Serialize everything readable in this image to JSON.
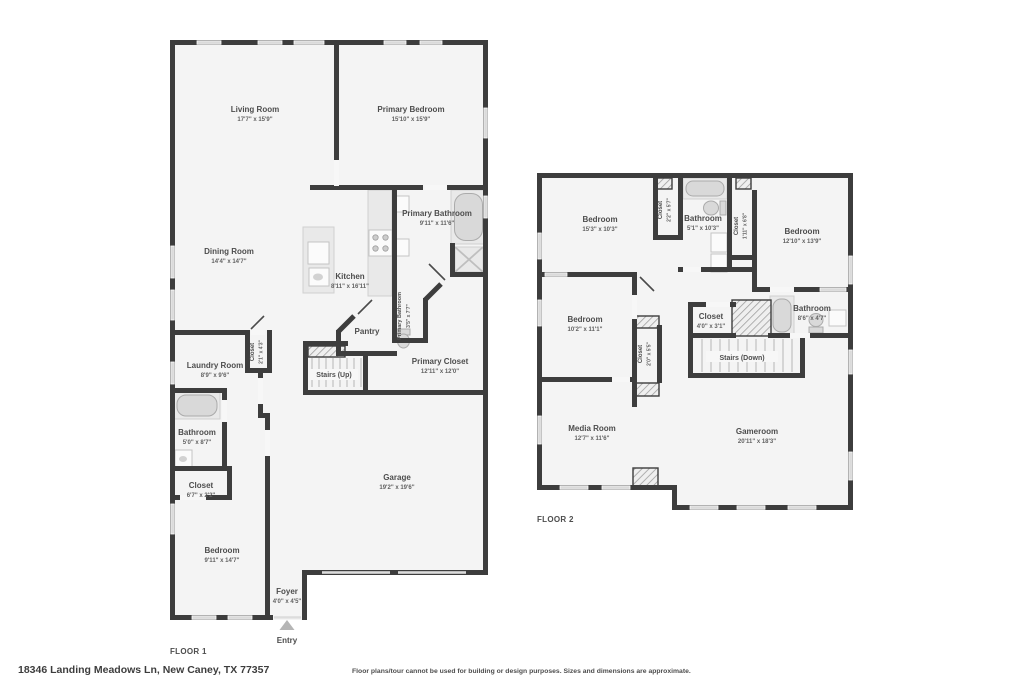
{
  "footer": {
    "address": "18346 Landing Meadows Ln, New Caney, TX 77357",
    "disclaimer": "Floor plans/tour cannot be used for building or design purposes. Sizes and dimensions are approximate."
  },
  "floor1": {
    "title": "FLOOR 1",
    "entry_label": "Entry",
    "rooms": {
      "living_room": {
        "name": "Living Room",
        "dims": "17'7\" x 15'9\""
      },
      "primary_bedroom": {
        "name": "Primary Bedroom",
        "dims": "15'10\" x 15'9\""
      },
      "primary_bathroom": {
        "name": "Primary Bathroom",
        "dims": "9'11\" x 11'6\""
      },
      "dining_room": {
        "name": "Dining Room",
        "dims": "14'4\" x 14'7\""
      },
      "kitchen": {
        "name": "Kitchen",
        "dims": "8'11\" x 16'11\""
      },
      "pantry": {
        "name": "Pantry"
      },
      "water_closet": {
        "name": "Primary Bathroom",
        "dims": "3'5\" x 7'7\""
      },
      "primary_closet": {
        "name": "Primary Closet",
        "dims": "12'11\" x 12'0\""
      },
      "hall_closet": {
        "name": "Closet",
        "dims": "2'1\" x 4'3\""
      },
      "laundry_room": {
        "name": "Laundry Room",
        "dims": "8'9\" x 9'6\""
      },
      "stairs": {
        "name": "Stairs (Up)"
      },
      "bathroom": {
        "name": "Bathroom",
        "dims": "5'0\" x 8'7\""
      },
      "bedroom_closet": {
        "name": "Closet",
        "dims": "6'7\" x 2'2\""
      },
      "bedroom": {
        "name": "Bedroom",
        "dims": "9'11\" x 14'7\""
      },
      "garage": {
        "name": "Garage",
        "dims": "19'2\" x 19'6\""
      },
      "foyer": {
        "name": "Foyer",
        "dims": "4'0\" x 4'5\""
      }
    }
  },
  "floor2": {
    "title": "FLOOR 2",
    "rooms": {
      "bedroom_a": {
        "name": "Bedroom",
        "dims": "15'3\" x 10'3\""
      },
      "closet_a": {
        "name": "Closet",
        "dims": "2'2\" x 5'7\""
      },
      "bathroom_a": {
        "name": "Bathroom",
        "dims": "5'1\" x 10'3\""
      },
      "closet_b": {
        "name": "Closet",
        "dims": "1'11\" x 6'8\""
      },
      "bedroom_b": {
        "name": "Bedroom",
        "dims": "12'10\" x 13'9\""
      },
      "bedroom_c": {
        "name": "Bedroom",
        "dims": "10'2\" x 11'1\""
      },
      "closet_c": {
        "name": "Closet",
        "dims": "2'0\" x 5'5\""
      },
      "closet_d": {
        "name": "Closet",
        "dims": "4'0\" x 3'1\""
      },
      "bathroom_b": {
        "name": "Bathroom",
        "dims": "8'6\" x 4'7\""
      },
      "stairs": {
        "name": "Stairs (Down)"
      },
      "media_room": {
        "name": "Media Room",
        "dims": "12'7\" x 11'6\""
      },
      "gameroom": {
        "name": "Gameroom",
        "dims": "20'11\" x 18'3\""
      }
    }
  },
  "colors": {
    "wall": "#3d3d3d",
    "floor_fill": "#f4f4f4",
    "label_text": "#4d4d4d"
  }
}
